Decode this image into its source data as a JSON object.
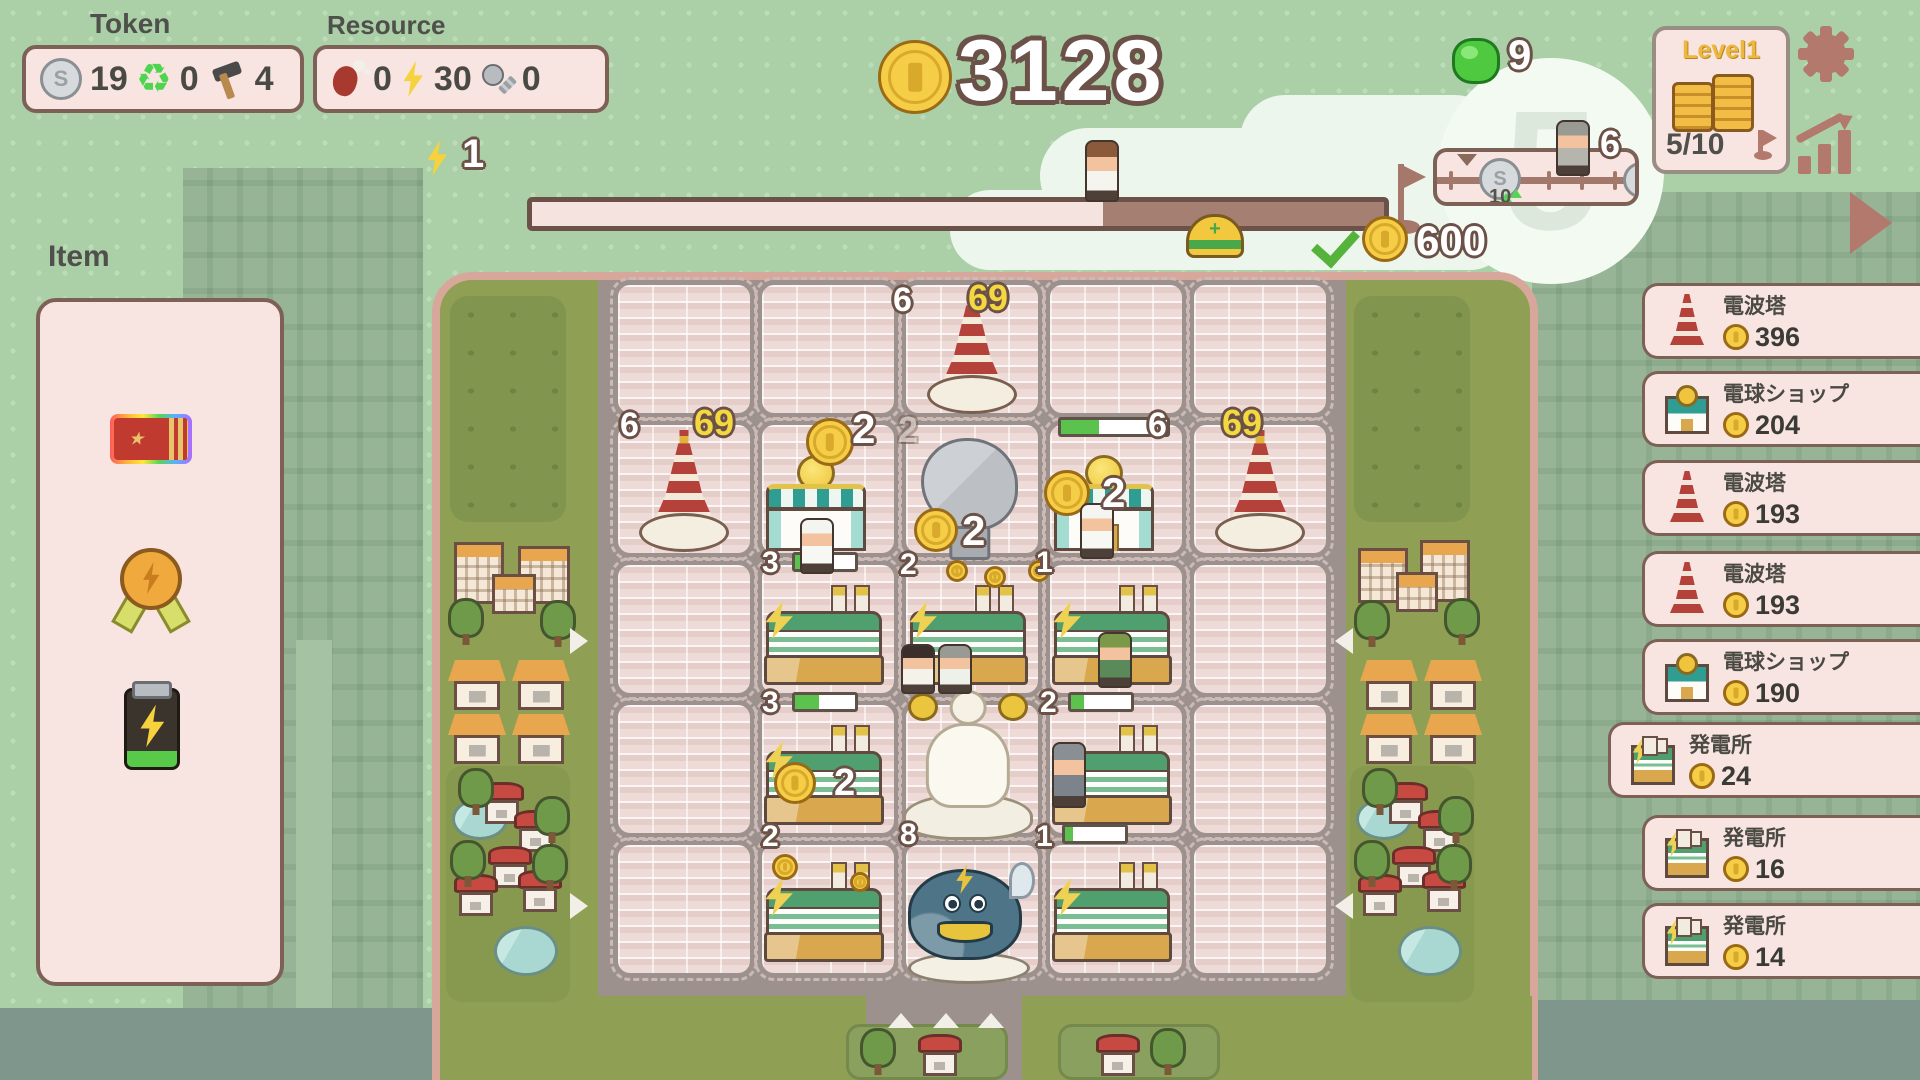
{
  "hud": {
    "token_label": "Token",
    "token": {
      "coin": "19",
      "recycle": "0",
      "hammer": "4"
    },
    "resource_label": "Resource",
    "resource": {
      "meat": "0",
      "energy": "30",
      "screw": "0"
    },
    "energy_float": "1",
    "coin_total": "3128",
    "gem_count": "9",
    "track": {
      "marker_value": "10"
    },
    "walker_value": "6",
    "cloud_number": "5",
    "level": {
      "title": "Level1",
      "progress": "5/10"
    },
    "goal": {
      "reward": "600"
    },
    "progress_fill_pct": 67
  },
  "item_panel": {
    "title": "Item",
    "items": [
      {
        "icon": "rainbow-ticket"
      },
      {
        "icon": "energy-medal"
      },
      {
        "icon": "energy-battery"
      }
    ]
  },
  "sidebar": {
    "items": [
      {
        "icon": "tower",
        "name": "電波塔",
        "value": "396",
        "y": 283,
        "selected": false
      },
      {
        "icon": "shop",
        "name": "電球ショップ",
        "value": "204",
        "y": 371,
        "selected": false
      },
      {
        "icon": "tower",
        "name": "電波塔",
        "value": "193",
        "y": 460,
        "selected": false
      },
      {
        "icon": "tower",
        "name": "電波塔",
        "value": "193",
        "y": 551,
        "selected": false
      },
      {
        "icon": "shop",
        "name": "電球ショップ",
        "value": "190",
        "y": 639,
        "selected": false
      },
      {
        "icon": "plant",
        "name": "発電所",
        "value": "24",
        "y": 722,
        "selected": true
      },
      {
        "icon": "plant",
        "name": "発電所",
        "value": "16",
        "y": 815,
        "selected": false
      },
      {
        "icon": "plant",
        "name": "発電所",
        "value": "14",
        "y": 903,
        "selected": false
      }
    ]
  },
  "board": {
    "cells": {
      "cols": [
        618,
        762,
        906,
        1050,
        1194
      ],
      "rows": [
        285,
        425,
        565,
        705,
        845
      ],
      "w": 132,
      "h": 128
    },
    "entities": [
      {
        "t": "tower",
        "x": 927,
        "y": 292,
        "w": 90,
        "h": 122
      },
      {
        "t": "tower",
        "x": 639,
        "y": 430,
        "w": 90,
        "h": 122
      },
      {
        "t": "tower",
        "x": 1215,
        "y": 430,
        "w": 90,
        "h": 122
      },
      {
        "t": "shop",
        "x": 766,
        "y": 455,
        "w": 100,
        "h": 96
      },
      {
        "t": "shop",
        "x": 1054,
        "y": 455,
        "w": 100,
        "h": 96
      },
      {
        "t": "dish",
        "x": 912,
        "y": 438,
        "w": 115,
        "h": 122
      },
      {
        "t": "plant",
        "x": 766,
        "y": 585,
        "w": 116,
        "h": 100
      },
      {
        "t": "plant",
        "x": 910,
        "y": 585,
        "w": 116,
        "h": 100
      },
      {
        "t": "plant",
        "x": 1054,
        "y": 585,
        "w": 116,
        "h": 100
      },
      {
        "t": "plant",
        "x": 766,
        "y": 725,
        "w": 116,
        "h": 100
      },
      {
        "t": "plant",
        "x": 1054,
        "y": 725,
        "w": 116,
        "h": 100
      },
      {
        "t": "plant",
        "x": 766,
        "y": 862,
        "w": 116,
        "h": 100
      },
      {
        "t": "plant",
        "x": 1054,
        "y": 862,
        "w": 116,
        "h": 100
      },
      {
        "t": "statue",
        "x": 900,
        "y": 682,
        "w": 136,
        "h": 158
      },
      {
        "t": "whale",
        "x": 903,
        "y": 862,
        "w": 132,
        "h": 122
      }
    ],
    "labels": [
      {
        "text": "6",
        "x": 893,
        "y": 283,
        "cls": "onum",
        "size": 34
      },
      {
        "text": "69",
        "x": 968,
        "y": 280,
        "cls": "ynum",
        "size": 36
      },
      {
        "text": "6",
        "x": 620,
        "y": 408,
        "cls": "onum",
        "size": 34
      },
      {
        "text": "69",
        "x": 694,
        "y": 405,
        "cls": "ynum",
        "size": 36
      },
      {
        "text": "6",
        "x": 1148,
        "y": 408,
        "cls": "onum",
        "size": 34
      },
      {
        "text": "69",
        "x": 1222,
        "y": 405,
        "cls": "ynum",
        "size": 36
      },
      {
        "text": "2",
        "x": 852,
        "y": 408,
        "cls": "onum",
        "size": 42
      },
      {
        "text": "2",
        "x": 898,
        "y": 412,
        "cls": "ghost",
        "size": 36
      },
      {
        "text": "2",
        "x": 1102,
        "y": 472,
        "cls": "onum",
        "size": 42
      },
      {
        "text": "2",
        "x": 962,
        "y": 510,
        "cls": "onum",
        "size": 42
      },
      {
        "text": "3",
        "x": 762,
        "y": 548,
        "cls": "onum",
        "size": 30
      },
      {
        "text": "2",
        "x": 900,
        "y": 550,
        "cls": "onum",
        "size": 30
      },
      {
        "text": "1",
        "x": 1036,
        "y": 548,
        "cls": "onum",
        "size": 30
      },
      {
        "text": "3",
        "x": 762,
        "y": 688,
        "cls": "onum",
        "size": 30
      },
      {
        "text": "2",
        "x": 1040,
        "y": 688,
        "cls": "onum",
        "size": 30
      },
      {
        "text": "2",
        "x": 834,
        "y": 764,
        "cls": "onum",
        "size": 38
      },
      {
        "text": "2",
        "x": 762,
        "y": 822,
        "cls": "onum",
        "size": 30
      },
      {
        "text": "8",
        "x": 900,
        "y": 820,
        "cls": "onum",
        "size": 30
      },
      {
        "text": "1",
        "x": 1036,
        "y": 822,
        "cls": "onum",
        "size": 30
      }
    ],
    "bars": [
      {
        "x": 1058,
        "y": 417,
        "w": 112,
        "fill": 36
      },
      {
        "x": 792,
        "y": 552,
        "w": 66,
        "fill": 14
      },
      {
        "x": 792,
        "y": 692,
        "w": 66,
        "fill": 40
      },
      {
        "x": 1068,
        "y": 692,
        "w": 66,
        "fill": 22
      },
      {
        "x": 1062,
        "y": 824,
        "w": 66,
        "fill": 14
      }
    ],
    "coins": [
      {
        "x": 806,
        "y": 418,
        "s": 48
      },
      {
        "x": 1044,
        "y": 470,
        "s": 46
      },
      {
        "x": 914,
        "y": 508,
        "s": 44
      },
      {
        "x": 946,
        "y": 560,
        "s": 22
      },
      {
        "x": 984,
        "y": 566,
        "s": 22
      },
      {
        "x": 1028,
        "y": 560,
        "s": 22
      },
      {
        "x": 774,
        "y": 762,
        "s": 42
      },
      {
        "x": 772,
        "y": 854,
        "s": 26
      },
      {
        "x": 850,
        "y": 872,
        "s": 20
      }
    ],
    "persons": [
      {
        "x": 800,
        "y": 518,
        "h": 52,
        "hat": "#f4f4f0",
        "shirt": "#f7f7f3",
        "name": "chef"
      },
      {
        "x": 1080,
        "y": 503,
        "h": 52,
        "hat": "#f4f4f0",
        "shirt": "#f7f7f3",
        "name": "chef"
      },
      {
        "x": 901,
        "y": 644,
        "h": 46,
        "hat": "#3a2f2a",
        "shirt": "#f5f2ea",
        "name": "villager"
      },
      {
        "x": 938,
        "y": 644,
        "h": 46,
        "hat": "#9a9a94",
        "shirt": "#eef0ea",
        "name": "villager"
      },
      {
        "x": 1098,
        "y": 632,
        "h": 52,
        "hat": "#7a9a4a",
        "shirt": "#5a8a5a",
        "name": "villager-green-hat"
      },
      {
        "x": 1052,
        "y": 742,
        "h": 62,
        "hat": "#8a8f94",
        "shirt": "#7d838a",
        "name": "detective"
      }
    ],
    "arrows": [
      {
        "dir": "right",
        "x": 570,
        "y": 628
      },
      {
        "dir": "right",
        "x": 570,
        "y": 893
      },
      {
        "dir": "left",
        "x": 1322,
        "y": 628
      },
      {
        "dir": "left",
        "x": 1322,
        "y": 893
      },
      {
        "dir": "up",
        "x": 888,
        "y": 1000
      },
      {
        "dir": "up",
        "x": 933,
        "y": 1000
      },
      {
        "dir": "up",
        "x": 978,
        "y": 1000
      }
    ],
    "decor": [
      {
        "t": "park",
        "x": 450,
        "y": 296,
        "w": 116,
        "h": 226
      },
      {
        "t": "park",
        "x": 1354,
        "y": 296,
        "w": 116,
        "h": 226
      },
      {
        "t": "patch",
        "x": 446,
        "y": 766,
        "w": 124,
        "h": 236
      },
      {
        "t": "patch",
        "x": 1350,
        "y": 766,
        "w": 124,
        "h": 236
      },
      {
        "t": "platform",
        "x": 846,
        "y": 1024,
        "w": 162,
        "h": 56
      },
      {
        "t": "platform",
        "x": 1058,
        "y": 1024,
        "w": 162,
        "h": 56
      },
      {
        "t": "bldg",
        "x": 454,
        "y": 542,
        "w": 50,
        "h": 62
      },
      {
        "t": "bldg",
        "x": 518,
        "y": 546,
        "w": 52,
        "h": 58
      },
      {
        "t": "bldg",
        "x": 492,
        "y": 574,
        "w": 44,
        "h": 40
      },
      {
        "t": "bldg",
        "x": 1358,
        "y": 548,
        "w": 50,
        "h": 55
      },
      {
        "t": "bldg",
        "x": 1420,
        "y": 540,
        "w": 50,
        "h": 62
      },
      {
        "t": "bldg",
        "x": 1396,
        "y": 572,
        "w": 42,
        "h": 40
      },
      {
        "t": "tree",
        "x": 448,
        "y": 598
      },
      {
        "t": "tree",
        "x": 540,
        "y": 600
      },
      {
        "t": "tree",
        "x": 1354,
        "y": 600
      },
      {
        "t": "tree",
        "x": 1444,
        "y": 598
      },
      {
        "t": "house_o",
        "x": 448,
        "y": 660
      },
      {
        "t": "house_o",
        "x": 512,
        "y": 660
      },
      {
        "t": "house_o",
        "x": 448,
        "y": 714
      },
      {
        "t": "house_o",
        "x": 512,
        "y": 714
      },
      {
        "t": "house_o",
        "x": 1360,
        "y": 660
      },
      {
        "t": "house_o",
        "x": 1424,
        "y": 660
      },
      {
        "t": "house_o",
        "x": 1360,
        "y": 714
      },
      {
        "t": "house_o",
        "x": 1424,
        "y": 714
      },
      {
        "t": "pond",
        "x": 452,
        "y": 798,
        "w": 56,
        "h": 42
      },
      {
        "t": "pond",
        "x": 494,
        "y": 926,
        "w": 64,
        "h": 50
      },
      {
        "t": "pond",
        "x": 1356,
        "y": 798,
        "w": 56,
        "h": 42
      },
      {
        "t": "pond",
        "x": 1398,
        "y": 926,
        "w": 64,
        "h": 50
      },
      {
        "t": "tree",
        "x": 458,
        "y": 768
      },
      {
        "t": "tree",
        "x": 534,
        "y": 796
      },
      {
        "t": "tree",
        "x": 450,
        "y": 840
      },
      {
        "t": "tree",
        "x": 532,
        "y": 844
      },
      {
        "t": "tree",
        "x": 1362,
        "y": 768
      },
      {
        "t": "tree",
        "x": 1438,
        "y": 796
      },
      {
        "t": "tree",
        "x": 1354,
        "y": 840
      },
      {
        "t": "tree",
        "x": 1436,
        "y": 844
      },
      {
        "t": "house_r",
        "x": 480,
        "y": 782
      },
      {
        "t": "house_r",
        "x": 514,
        "y": 810
      },
      {
        "t": "house_r",
        "x": 488,
        "y": 846
      },
      {
        "t": "house_r",
        "x": 454,
        "y": 874
      },
      {
        "t": "house_r",
        "x": 518,
        "y": 870
      },
      {
        "t": "house_r",
        "x": 1384,
        "y": 782
      },
      {
        "t": "house_r",
        "x": 1418,
        "y": 810
      },
      {
        "t": "house_r",
        "x": 1392,
        "y": 846
      },
      {
        "t": "house_r",
        "x": 1358,
        "y": 874
      },
      {
        "t": "house_r",
        "x": 1422,
        "y": 870
      },
      {
        "t": "tree",
        "x": 860,
        "y": 1028
      },
      {
        "t": "house_r",
        "x": 918,
        "y": 1034
      },
      {
        "t": "house_r",
        "x": 1096,
        "y": 1034
      },
      {
        "t": "tree",
        "x": 1150,
        "y": 1028
      }
    ]
  }
}
